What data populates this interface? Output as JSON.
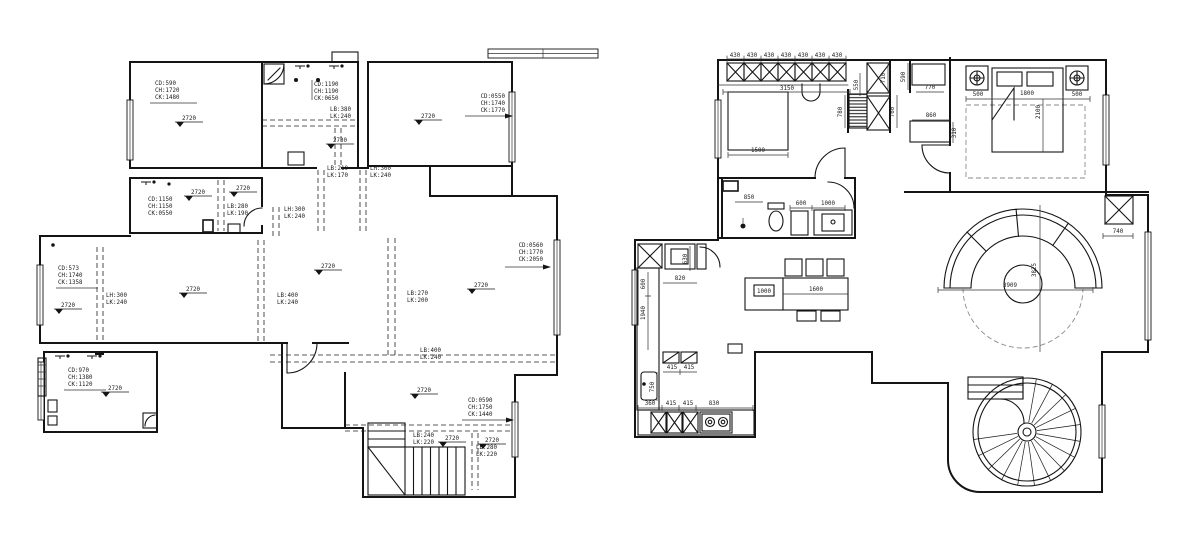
{
  "document": {
    "type": "cad-ceiling-and-furniture-floor-plans",
    "background": "#ffffff",
    "line_color": "#141414"
  },
  "plans": {
    "left": {
      "name": "floor-plan-1-ceiling-plan",
      "ceiling_annotations": [
        {
          "x": 155,
          "y": 85,
          "lines": [
            "CD:590",
            "CH:1720",
            "CK:1480"
          ]
        },
        {
          "x": 314,
          "y": 86,
          "lines": [
            "CD:1190",
            "CH:1190",
            "CK:0650"
          ]
        },
        {
          "x": 505,
          "y": 98,
          "anchor": "end",
          "lines": [
            "CD:0550",
            "CH:1740",
            "CK:1770"
          ]
        },
        {
          "x": 148,
          "y": 201,
          "lines": [
            "CD:1150",
            "CH:1150",
            "CK:0550"
          ]
        },
        {
          "x": 58,
          "y": 270,
          "lines": [
            "CD:573",
            "CH:1740",
            "CK:1358"
          ]
        },
        {
          "x": 68,
          "y": 372,
          "lines": [
            "CD:970",
            "CH:1380",
            "CK:1120"
          ]
        },
        {
          "x": 543,
          "y": 247,
          "anchor": "end",
          "lines": [
            "CD:0560",
            "CH:1770",
            "CK:2050"
          ]
        },
        {
          "x": 468,
          "y": 402,
          "lines": [
            "CD:0590",
            "CH:1750",
            "CK:1440"
          ]
        }
      ],
      "beam_annotations": [
        {
          "x": 330,
          "y": 111,
          "lines": [
            "LB:380",
            "LK:240"
          ]
        },
        {
          "x": 327,
          "y": 170,
          "lines": [
            "LB:210",
            "LK:170"
          ]
        },
        {
          "x": 370,
          "y": 170,
          "lines": [
            "LH:300",
            "LK:240"
          ]
        },
        {
          "x": 227,
          "y": 208,
          "lines": [
            "LB:280",
            "LK:190"
          ]
        },
        {
          "x": 284,
          "y": 211,
          "lines": [
            "LH:300",
            "LK:240"
          ]
        },
        {
          "x": 106,
          "y": 297,
          "lines": [
            "LH:300",
            "LK:240"
          ]
        },
        {
          "x": 277,
          "y": 297,
          "lines": [
            "LB:400",
            "LK:240"
          ]
        },
        {
          "x": 407,
          "y": 295,
          "lines": [
            "LB:270",
            "LK:200"
          ]
        },
        {
          "x": 420,
          "y": 352,
          "lines": [
            "LB:400",
            "LK:240"
          ]
        },
        {
          "x": 413,
          "y": 437,
          "lines": [
            "LB:240",
            "LK:220"
          ]
        },
        {
          "x": 476,
          "y": 449,
          "lines": [
            "LB:280",
            "LK:220"
          ]
        }
      ],
      "elevation_markers": [
        {
          "x": 175,
          "y": 114,
          "value": "2720"
        },
        {
          "x": 326,
          "y": 136,
          "value": "2730"
        },
        {
          "x": 414,
          "y": 112,
          "value": "2720"
        },
        {
          "x": 184,
          "y": 188,
          "value": "2720"
        },
        {
          "x": 229,
          "y": 184,
          "value": "2720"
        },
        {
          "x": 54,
          "y": 301,
          "value": "2720"
        },
        {
          "x": 179,
          "y": 285,
          "value": "2720"
        },
        {
          "x": 314,
          "y": 262,
          "value": "2720"
        },
        {
          "x": 467,
          "y": 281,
          "value": "2720"
        },
        {
          "x": 101,
          "y": 384,
          "value": "2720"
        },
        {
          "x": 410,
          "y": 386,
          "value": "2720"
        },
        {
          "x": 438,
          "y": 434,
          "value": "2720"
        },
        {
          "x": 478,
          "y": 436,
          "value": "2720"
        }
      ]
    },
    "right": {
      "name": "floor-plan-2-furniture-plan",
      "dimensions": [
        {
          "value": "430",
          "x": 735,
          "y": 57
        },
        {
          "value": "430",
          "x": 752,
          "y": 57
        },
        {
          "value": "430",
          "x": 769,
          "y": 57
        },
        {
          "value": "430",
          "x": 786,
          "y": 57
        },
        {
          "value": "430",
          "x": 803,
          "y": 57
        },
        {
          "value": "430",
          "x": 820,
          "y": 57
        },
        {
          "value": "430",
          "x": 837,
          "y": 57
        },
        {
          "value": "3150",
          "x": 787,
          "y": 90
        },
        {
          "value": "1500",
          "x": 758,
          "y": 152
        },
        {
          "value": "550",
          "x": 858,
          "y": 85,
          "rot": -90
        },
        {
          "value": "780",
          "x": 842,
          "y": 112,
          "rot": -90
        },
        {
          "value": "710",
          "x": 885,
          "y": 78,
          "rot": -90
        },
        {
          "value": "590",
          "x": 905,
          "y": 77,
          "rot": -90
        },
        {
          "value": "760",
          "x": 894,
          "y": 112,
          "rot": -90
        },
        {
          "value": "770",
          "x": 930,
          "y": 89
        },
        {
          "value": "860",
          "x": 931,
          "y": 117
        },
        {
          "value": "310",
          "x": 956,
          "y": 133,
          "rot": -90
        },
        {
          "value": "500",
          "x": 978,
          "y": 96
        },
        {
          "value": "1800",
          "x": 1027,
          "y": 95
        },
        {
          "value": "500",
          "x": 1077,
          "y": 96
        },
        {
          "value": "2100",
          "x": 1040,
          "y": 112,
          "rot": -90
        },
        {
          "value": "850",
          "x": 749,
          "y": 199
        },
        {
          "value": "600",
          "x": 801,
          "y": 205
        },
        {
          "value": "1000",
          "x": 828,
          "y": 205
        },
        {
          "value": "630",
          "x": 687,
          "y": 259,
          "rot": -90
        },
        {
          "value": "820",
          "x": 680,
          "y": 280
        },
        {
          "value": "600",
          "x": 645,
          "y": 284,
          "rot": -90
        },
        {
          "value": "1940",
          "x": 645,
          "y": 313,
          "rot": -90
        },
        {
          "value": "750",
          "x": 654,
          "y": 387,
          "rot": -90
        },
        {
          "value": "415",
          "x": 672,
          "y": 369
        },
        {
          "value": "415",
          "x": 689,
          "y": 369
        },
        {
          "value": "360",
          "x": 650,
          "y": 405
        },
        {
          "value": "415",
          "x": 671,
          "y": 405
        },
        {
          "value": "415",
          "x": 688,
          "y": 405
        },
        {
          "value": "830",
          "x": 714,
          "y": 405
        },
        {
          "value": "1000",
          "x": 764,
          "y": 293
        },
        {
          "value": "1600",
          "x": 816,
          "y": 291
        },
        {
          "value": "3909",
          "x": 1010,
          "y": 287
        },
        {
          "value": "3825",
          "x": 1036,
          "y": 270,
          "rot": -90
        },
        {
          "value": "740",
          "x": 1118,
          "y": 233
        }
      ]
    }
  }
}
